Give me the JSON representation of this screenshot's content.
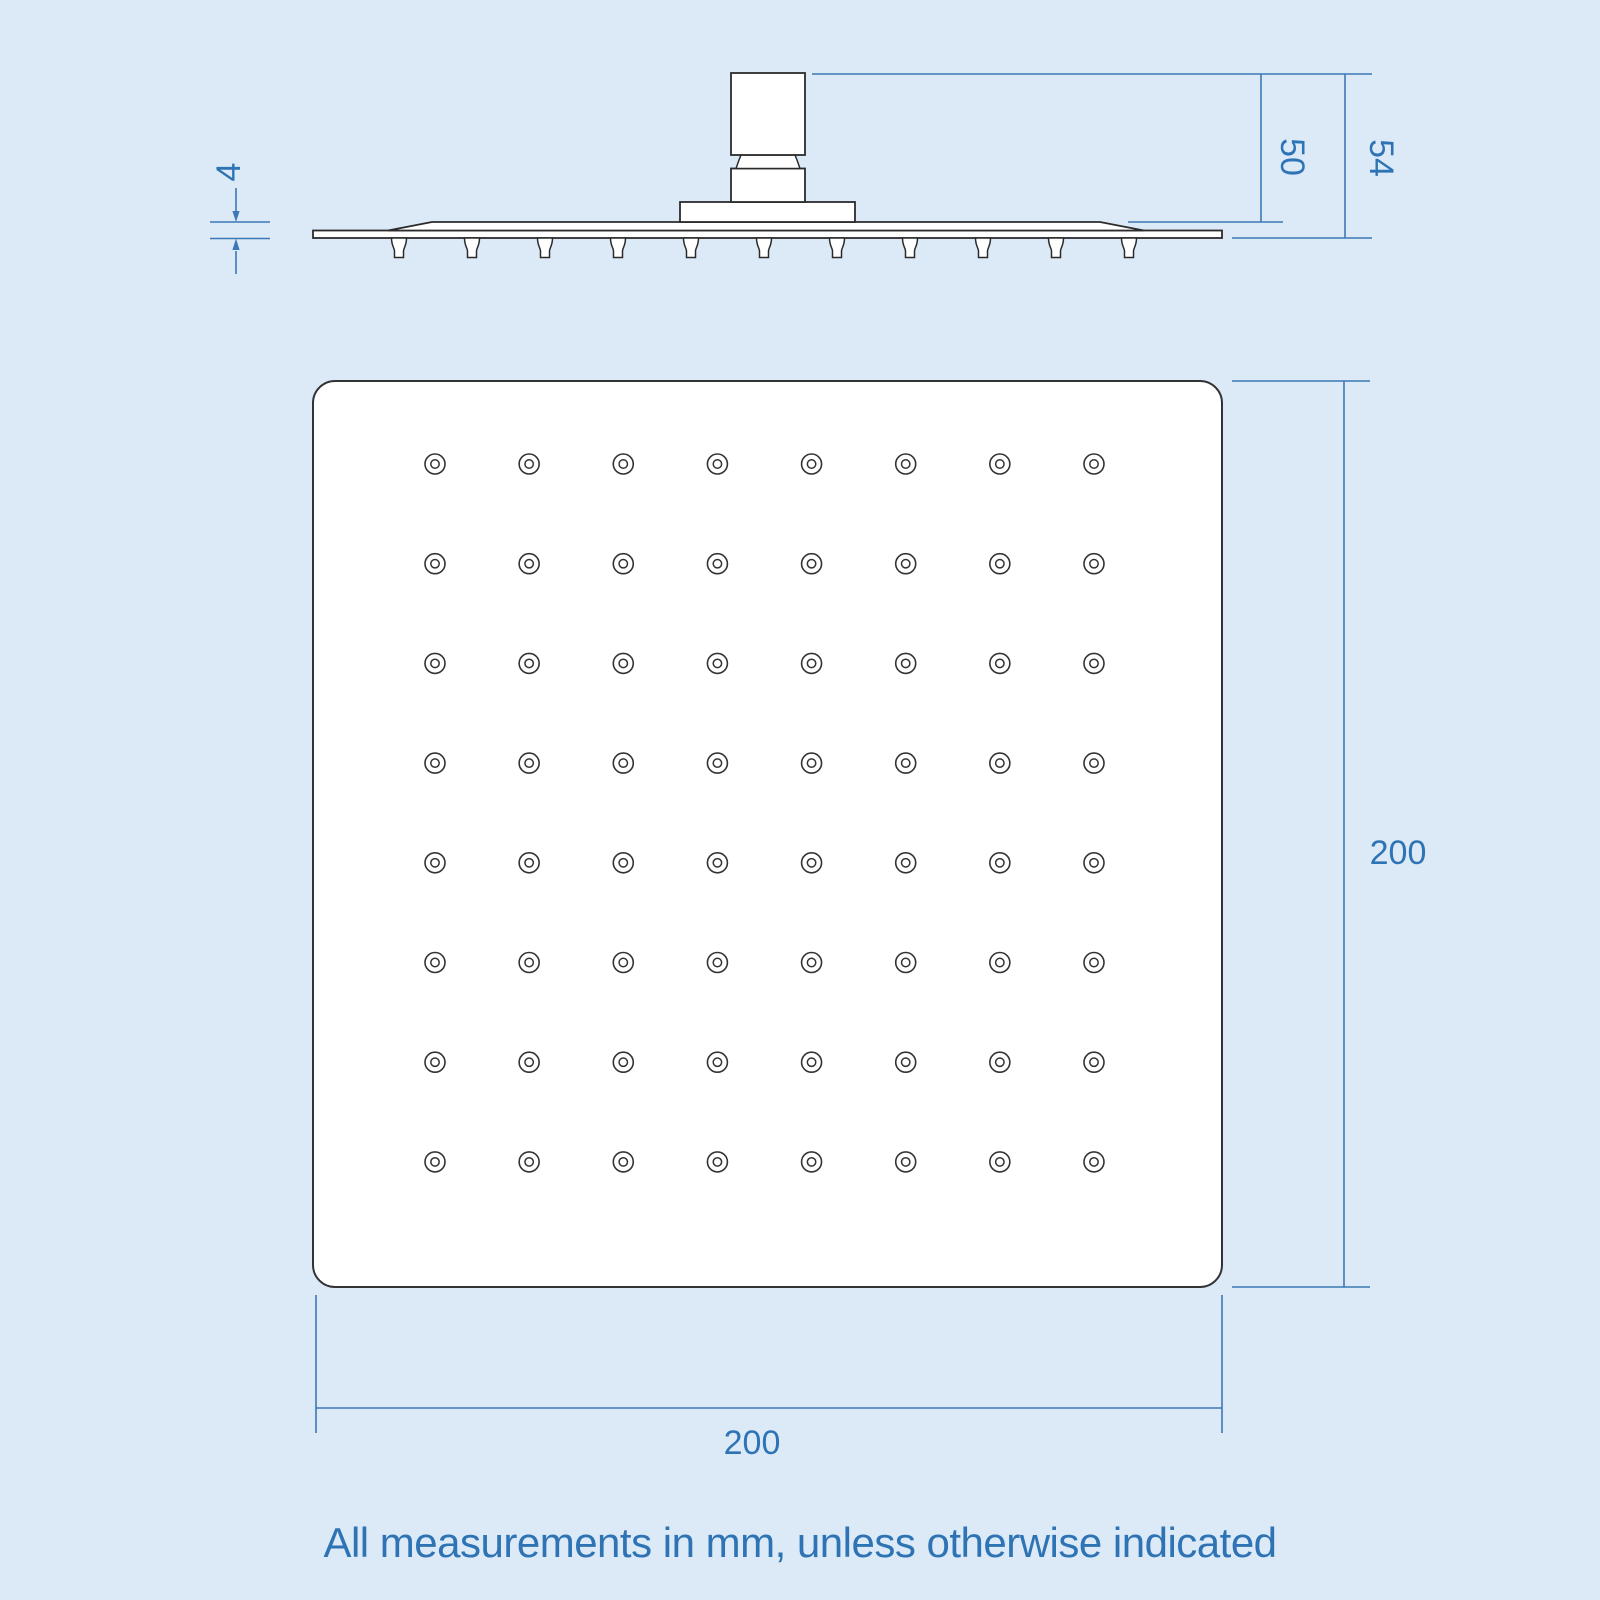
{
  "note": "All measurements in mm, unless otherwise indicated",
  "colors": {
    "background": "#dce9f7",
    "drawing_line": "#2b2b2b",
    "dimension_line": "#3b79b6",
    "dimension_text": "#2e74b5"
  },
  "side_view": {
    "dims": {
      "plate_thickness": "4",
      "head_height": "50",
      "total_height": "54"
    },
    "nozzle_count": 11
  },
  "face_view": {
    "dims": {
      "width": "200",
      "height": "200"
    },
    "grid": {
      "rows": 8,
      "cols": 8
    }
  }
}
